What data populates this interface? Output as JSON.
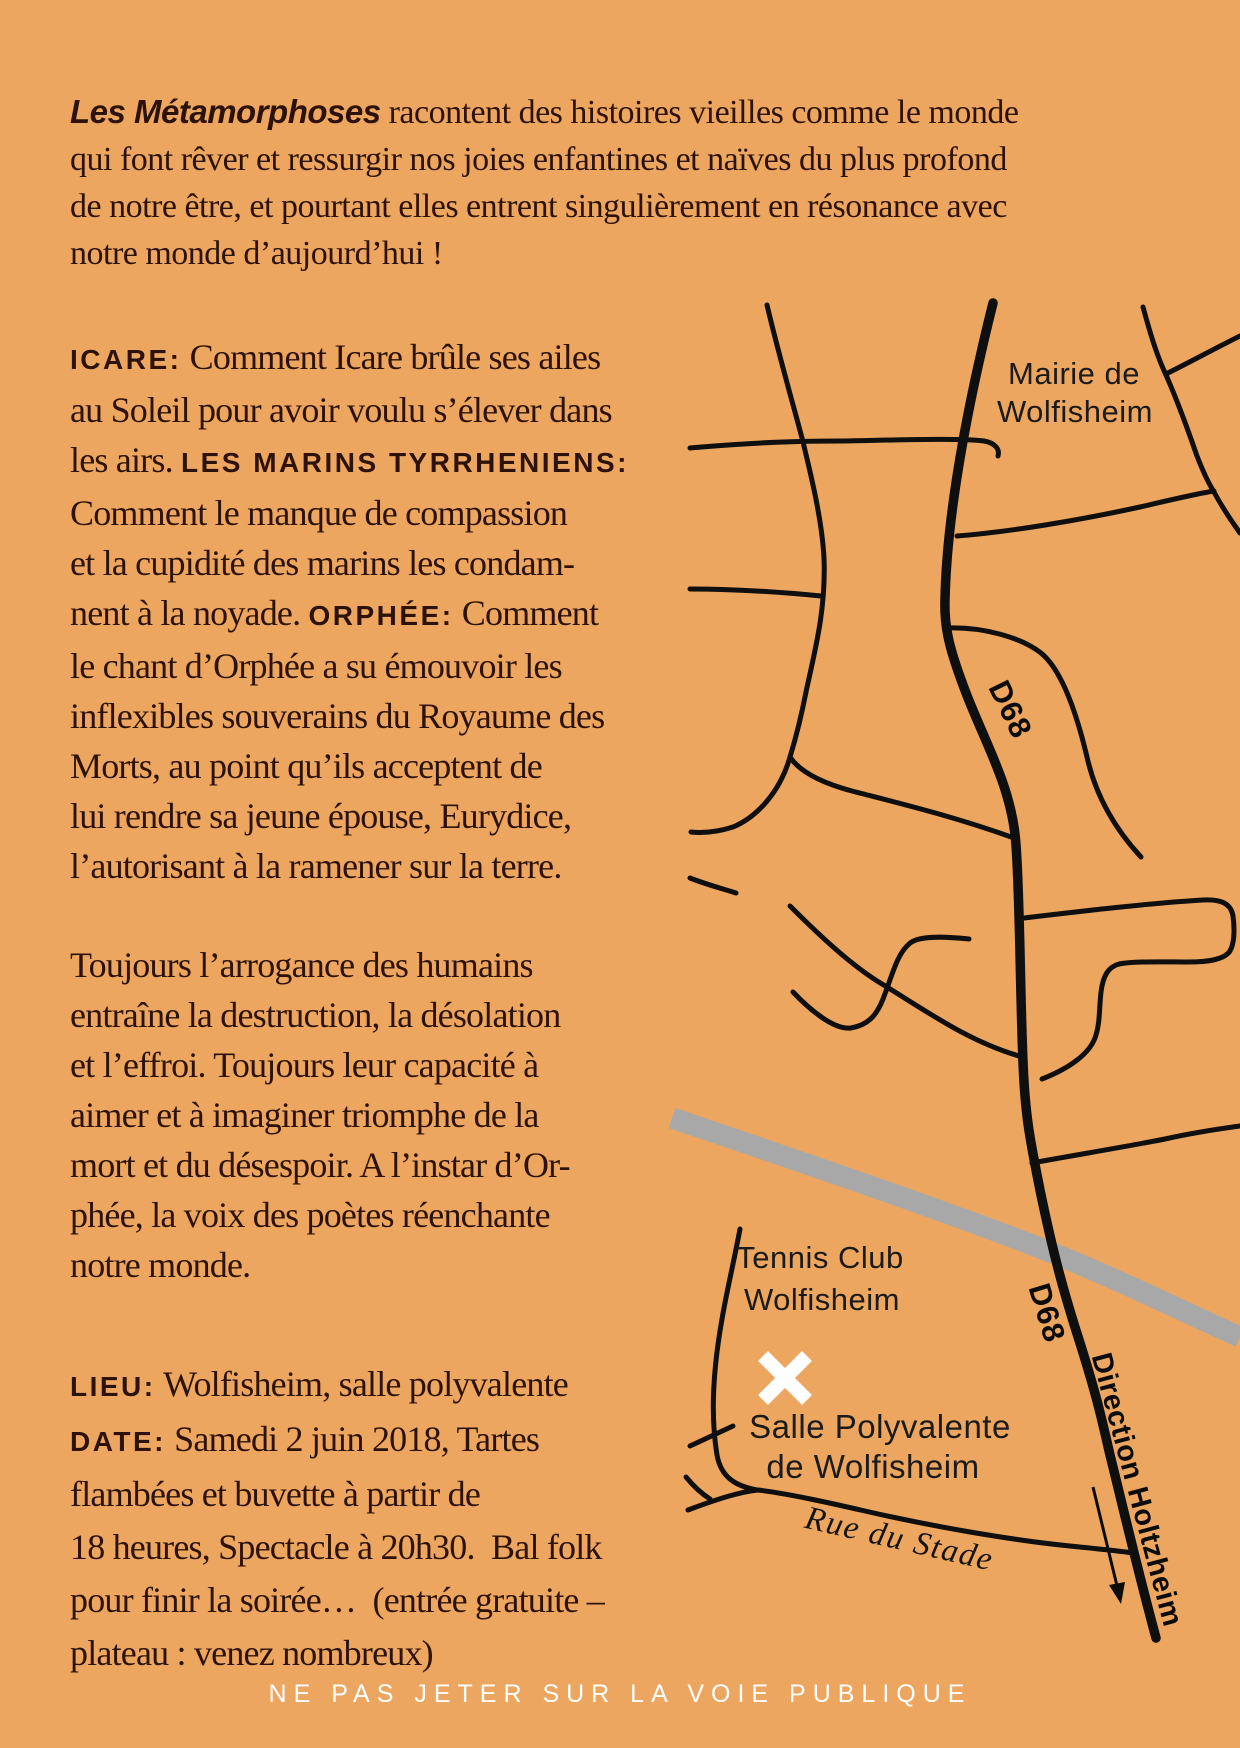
{
  "page": {
    "background": "#eca65f",
    "ink": "#2d120a",
    "road_color": "#0f0f0f",
    "highway_color": "#a8a8a8",
    "marker_color": "#ffffff"
  },
  "intro": {
    "title": "Les Métamorphoses",
    "l1_rest": " racontent des histoires vieilles comme le monde",
    "l2": "qui font rêver et ressurgir nos joies enfantines et naïves du plus profond",
    "l3": "de notre être, et pourtant elles entrent singulièrement en résonance avec",
    "l4": "notre monde d’aujourd’hui !"
  },
  "column": {
    "icare": {
      "l1_label": "ICARE:",
      "l1_rest": " Comment Icare brûle ses ailes",
      "l2": "au Soleil pour avoir voulu s’élever dans",
      "l3_pre": "les airs. ",
      "l3_label": "LES MARINS TYRRHENIENS:",
      "l4": "Comment le manque de compassion",
      "l5": "et la cupidité des marins les condam-",
      "l6_pre": "nent à la noyade. ",
      "l6_label": "ORPHÉE:",
      "l6_rest": " Comment",
      "l7": "le chant d’Orphée a su émouvoir les",
      "l8": "inflexibles souverains du Royaume des",
      "l9": "Morts, au point qu’ils acceptent de",
      "l10": "lui rendre sa jeune épouse, Eurydice,",
      "l11": "l’autorisant à la ramener sur la terre."
    },
    "toujours": {
      "l1": "Toujours l’arrogance des humains",
      "l2": "entraîne la destruction, la désolation",
      "l3": "et l’effroi. Toujours leur capacité à",
      "l4": "aimer et à imaginer triomphe de la",
      "l5": "mort et du désespoir. A l’instar d’Or-",
      "l6": "phée, la voix des poètes réenchante",
      "l7": "notre monde."
    },
    "lieu": {
      "label": "LIEU:",
      "rest": " Wolfisheim, salle polyvalente"
    },
    "date": {
      "label": "DATE:",
      "l1_rest": " Samedi 2 juin 2018, Tartes",
      "l2": "flambées et buvette à partir de",
      "l3": "18 heures, Spectacle à 20h30.  Bal folk",
      "l4": "pour finir la soirée…  (entrée gratuite –",
      "l5": "plateau : venez nombreux)"
    }
  },
  "map": {
    "labels": {
      "mairie_1": "Mairie de",
      "mairie_2": "Wolfisheim",
      "d68_upper": "D68",
      "d68_lower": "D68",
      "tennis_1": "Tennis Club",
      "tennis_2": "Wolfisheim",
      "salle_1": "Salle Polyvalente",
      "salle_2": "de Wolfisheim",
      "rue_du_stade": "Rue du Stade",
      "direction": "Direction Holtzheim"
    }
  },
  "footer": {
    "notice": "NE PAS JETER SUR LA VOIE PUBLIQUE"
  }
}
